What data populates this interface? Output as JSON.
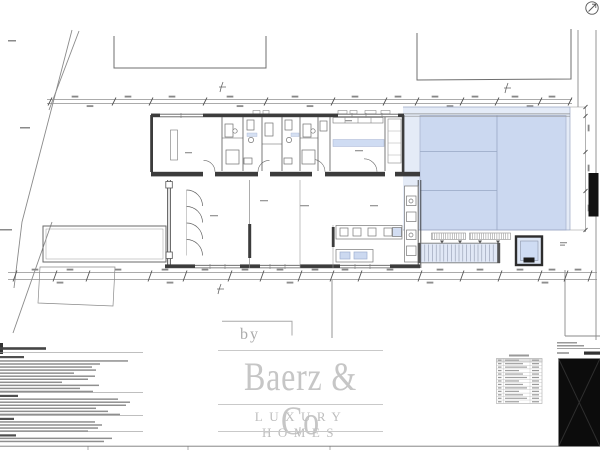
{
  "watermark": {
    "by": "by",
    "brand": "Baerz & Co",
    "tagline": "LUXURY HOMES"
  },
  "icons": {
    "north_arrow": "↗"
  },
  "colors": {
    "paper": "#ffffff",
    "wall_linework": "#3c3c3c",
    "dimension_lines": "#909090",
    "terrace_highlight": "#c3d2ee",
    "titleblock_box": "#0c0c0c",
    "watermark_gray": "#c6c6c6"
  }
}
